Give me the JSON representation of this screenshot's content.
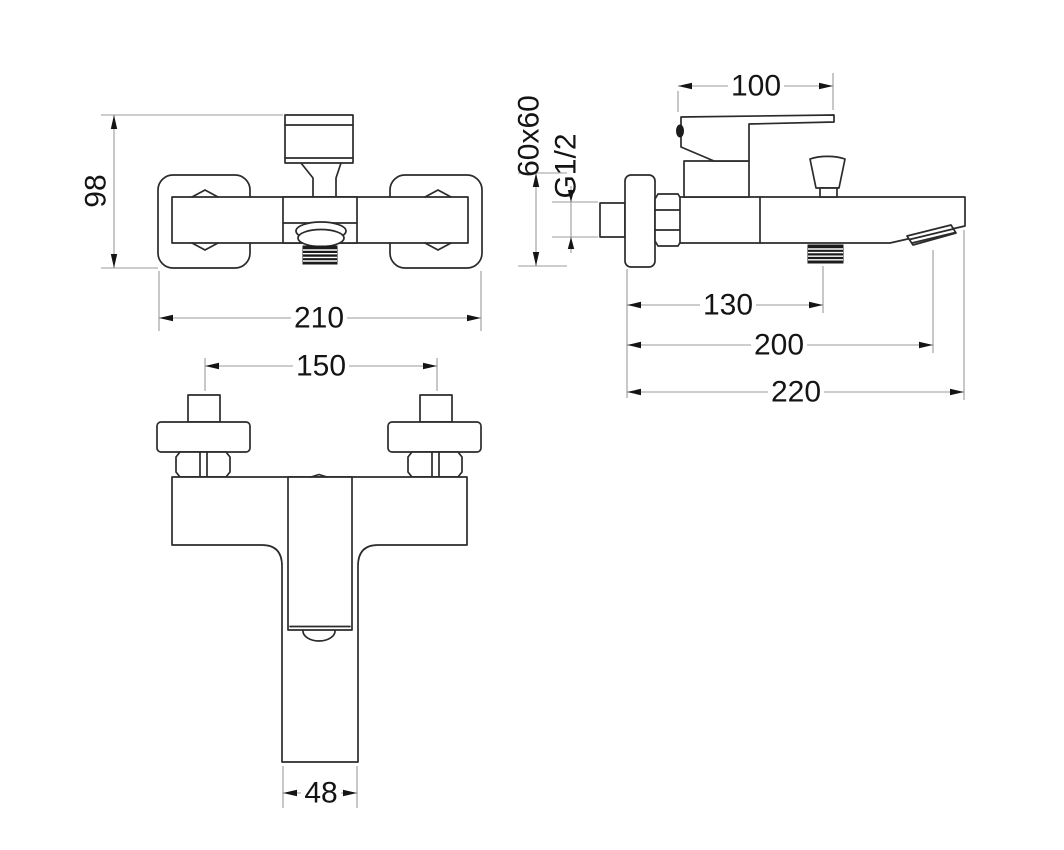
{
  "drawing": {
    "type": "technical-orthographic-drawing",
    "dimensions": {
      "front_height": "98",
      "front_width": "210",
      "plan_hole_spacing": "150",
      "plan_spout_width": "48",
      "side_handle_length": "100",
      "side_flange_size": "60x60",
      "side_thread_size": "G1/2",
      "side_shower_outlet_offset": "130",
      "side_spout_reach": "200",
      "side_overall_reach": "220"
    },
    "colors": {
      "background": "#ffffff",
      "outline": "#2b2b2b",
      "dimension_line": "#9b9b9b",
      "arrow": "#141414",
      "label": "#141414"
    }
  }
}
